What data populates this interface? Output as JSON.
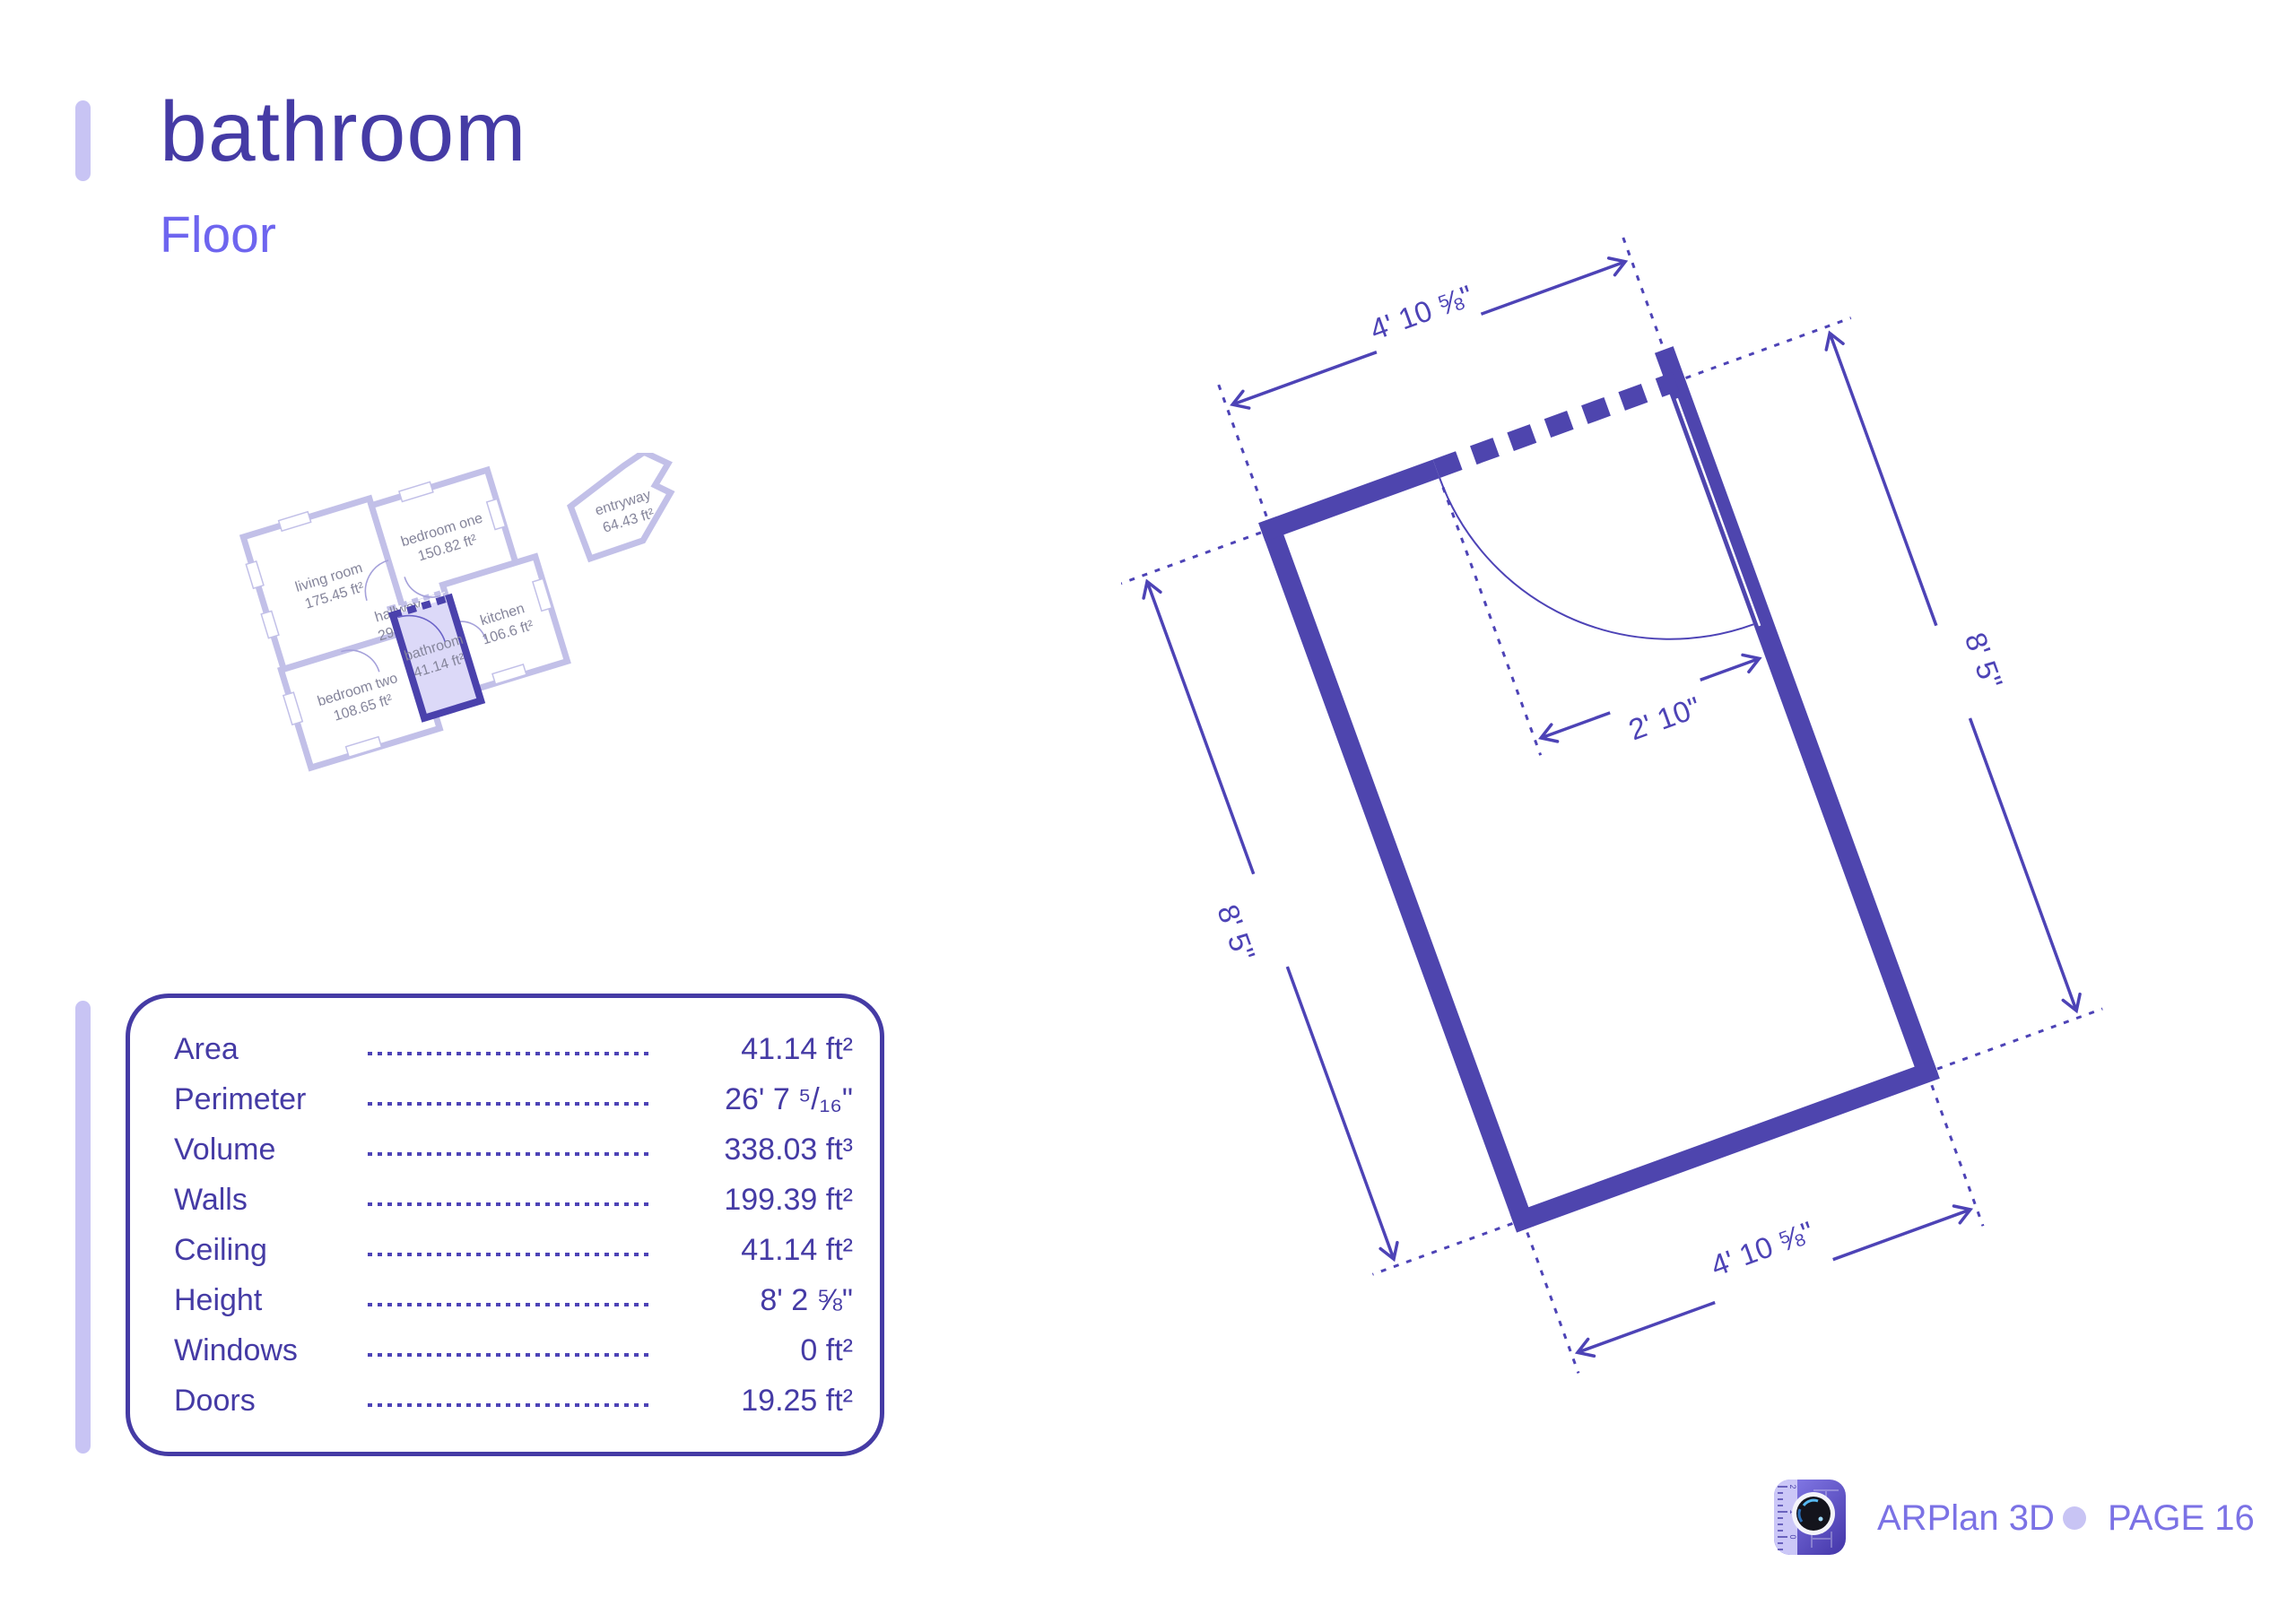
{
  "header": {
    "title": "bathroom",
    "subtitle": "Floor"
  },
  "stats": {
    "rows": [
      {
        "label": "Area",
        "value": "41.14 ft²"
      },
      {
        "label": "Perimeter",
        "value": "26' 7 ⁵/₁₆\""
      },
      {
        "label": "Volume",
        "value": "338.03 ft³"
      },
      {
        "label": "Walls",
        "value": "199.39 ft²"
      },
      {
        "label": "Ceiling",
        "value": "41.14 ft²"
      },
      {
        "label": "Height",
        "value": "8' 2 ⅝\""
      },
      {
        "label": "Windows",
        "value": "0 ft²"
      },
      {
        "label": "Doors",
        "value": "19.25 ft²"
      }
    ]
  },
  "mini_plan": {
    "rooms": [
      {
        "name": "living room",
        "area": "175.45 ft²"
      },
      {
        "name": "bedroom one",
        "area": "150.82 ft²"
      },
      {
        "name": "bedroom two",
        "area": "108.65 ft²"
      },
      {
        "name": "kitchen",
        "area": "106.6 ft²"
      },
      {
        "name": "hallway",
        "area": "29.67 ft²"
      },
      {
        "name": "bathroom",
        "area": "41.14 ft²"
      },
      {
        "name": "entryway",
        "area": "64.43 ft²"
      }
    ]
  },
  "diagram": {
    "dim_top": "4' 10 ⅝\"",
    "dim_bottom": "4' 10 ⅝\"",
    "dim_left": "8' 5\"",
    "dim_right": "8' 5\"",
    "dim_door": "2' 10\""
  },
  "footer": {
    "app_name": "ARPlan 3D",
    "page_label": "PAGE 16",
    "ruler_numbers": [
      "2",
      "1",
      "0"
    ]
  },
  "colors": {
    "ink": "#453ba5",
    "dimension_line": "#4d43b6",
    "wall": "#4e45ae",
    "accent_light": "#c8c4f4",
    "plan_wall": "#c2c0e8",
    "room_label_gray": "#85859b",
    "footer_purple": "#7b72e5",
    "bathroom_fill": "#dcd9f8",
    "bathroom_wall": "#4a41ac",
    "subtitle": "#6e65ef"
  }
}
